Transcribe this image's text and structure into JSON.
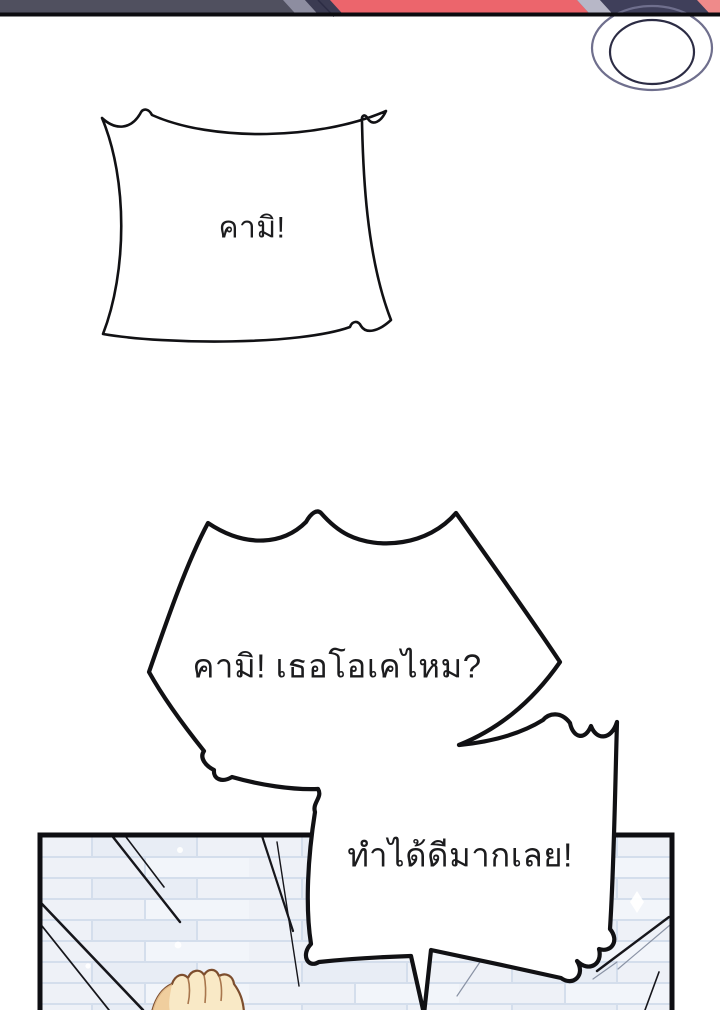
{
  "page": {
    "type": "comic-page",
    "background": "#ffffff"
  },
  "top_strip": {
    "description": "bottom sliver of previous panel artwork",
    "colors": {
      "slate": "#50505f",
      "light_band": "#8d8da0",
      "navy_band": "#3b3b52",
      "red": "#ec656c",
      "lavender_band": "#b7b7c7",
      "navy_right": "#3f3f5a",
      "salmon": "#ef8a8a",
      "divider_black": "#0c0c10"
    }
  },
  "speech_bubbles": [
    {
      "id": "shout-box",
      "shape": "spiky-rectangle",
      "text": "คามิ!"
    },
    {
      "id": "shout-burst",
      "shape": "spiky-burst",
      "text": "คามิ! เธอโอเคไหม?"
    },
    {
      "id": "shout-round",
      "shape": "scalloped-burst",
      "text": "ทำได้ดีมากเลย!"
    }
  ],
  "panel": {
    "wall": {
      "base": "#eef1f7",
      "mortar": "#d4deec",
      "border": "#0e0e12"
    },
    "speed_line_color": "#16161b",
    "faint_line_color": "#8a93a5",
    "sparkle_color": "#ffffff",
    "fist": {
      "skin": "#f9e9c6",
      "shade": "#eec997",
      "outline": "#7d4e2e",
      "crease": "#a8764d"
    }
  }
}
